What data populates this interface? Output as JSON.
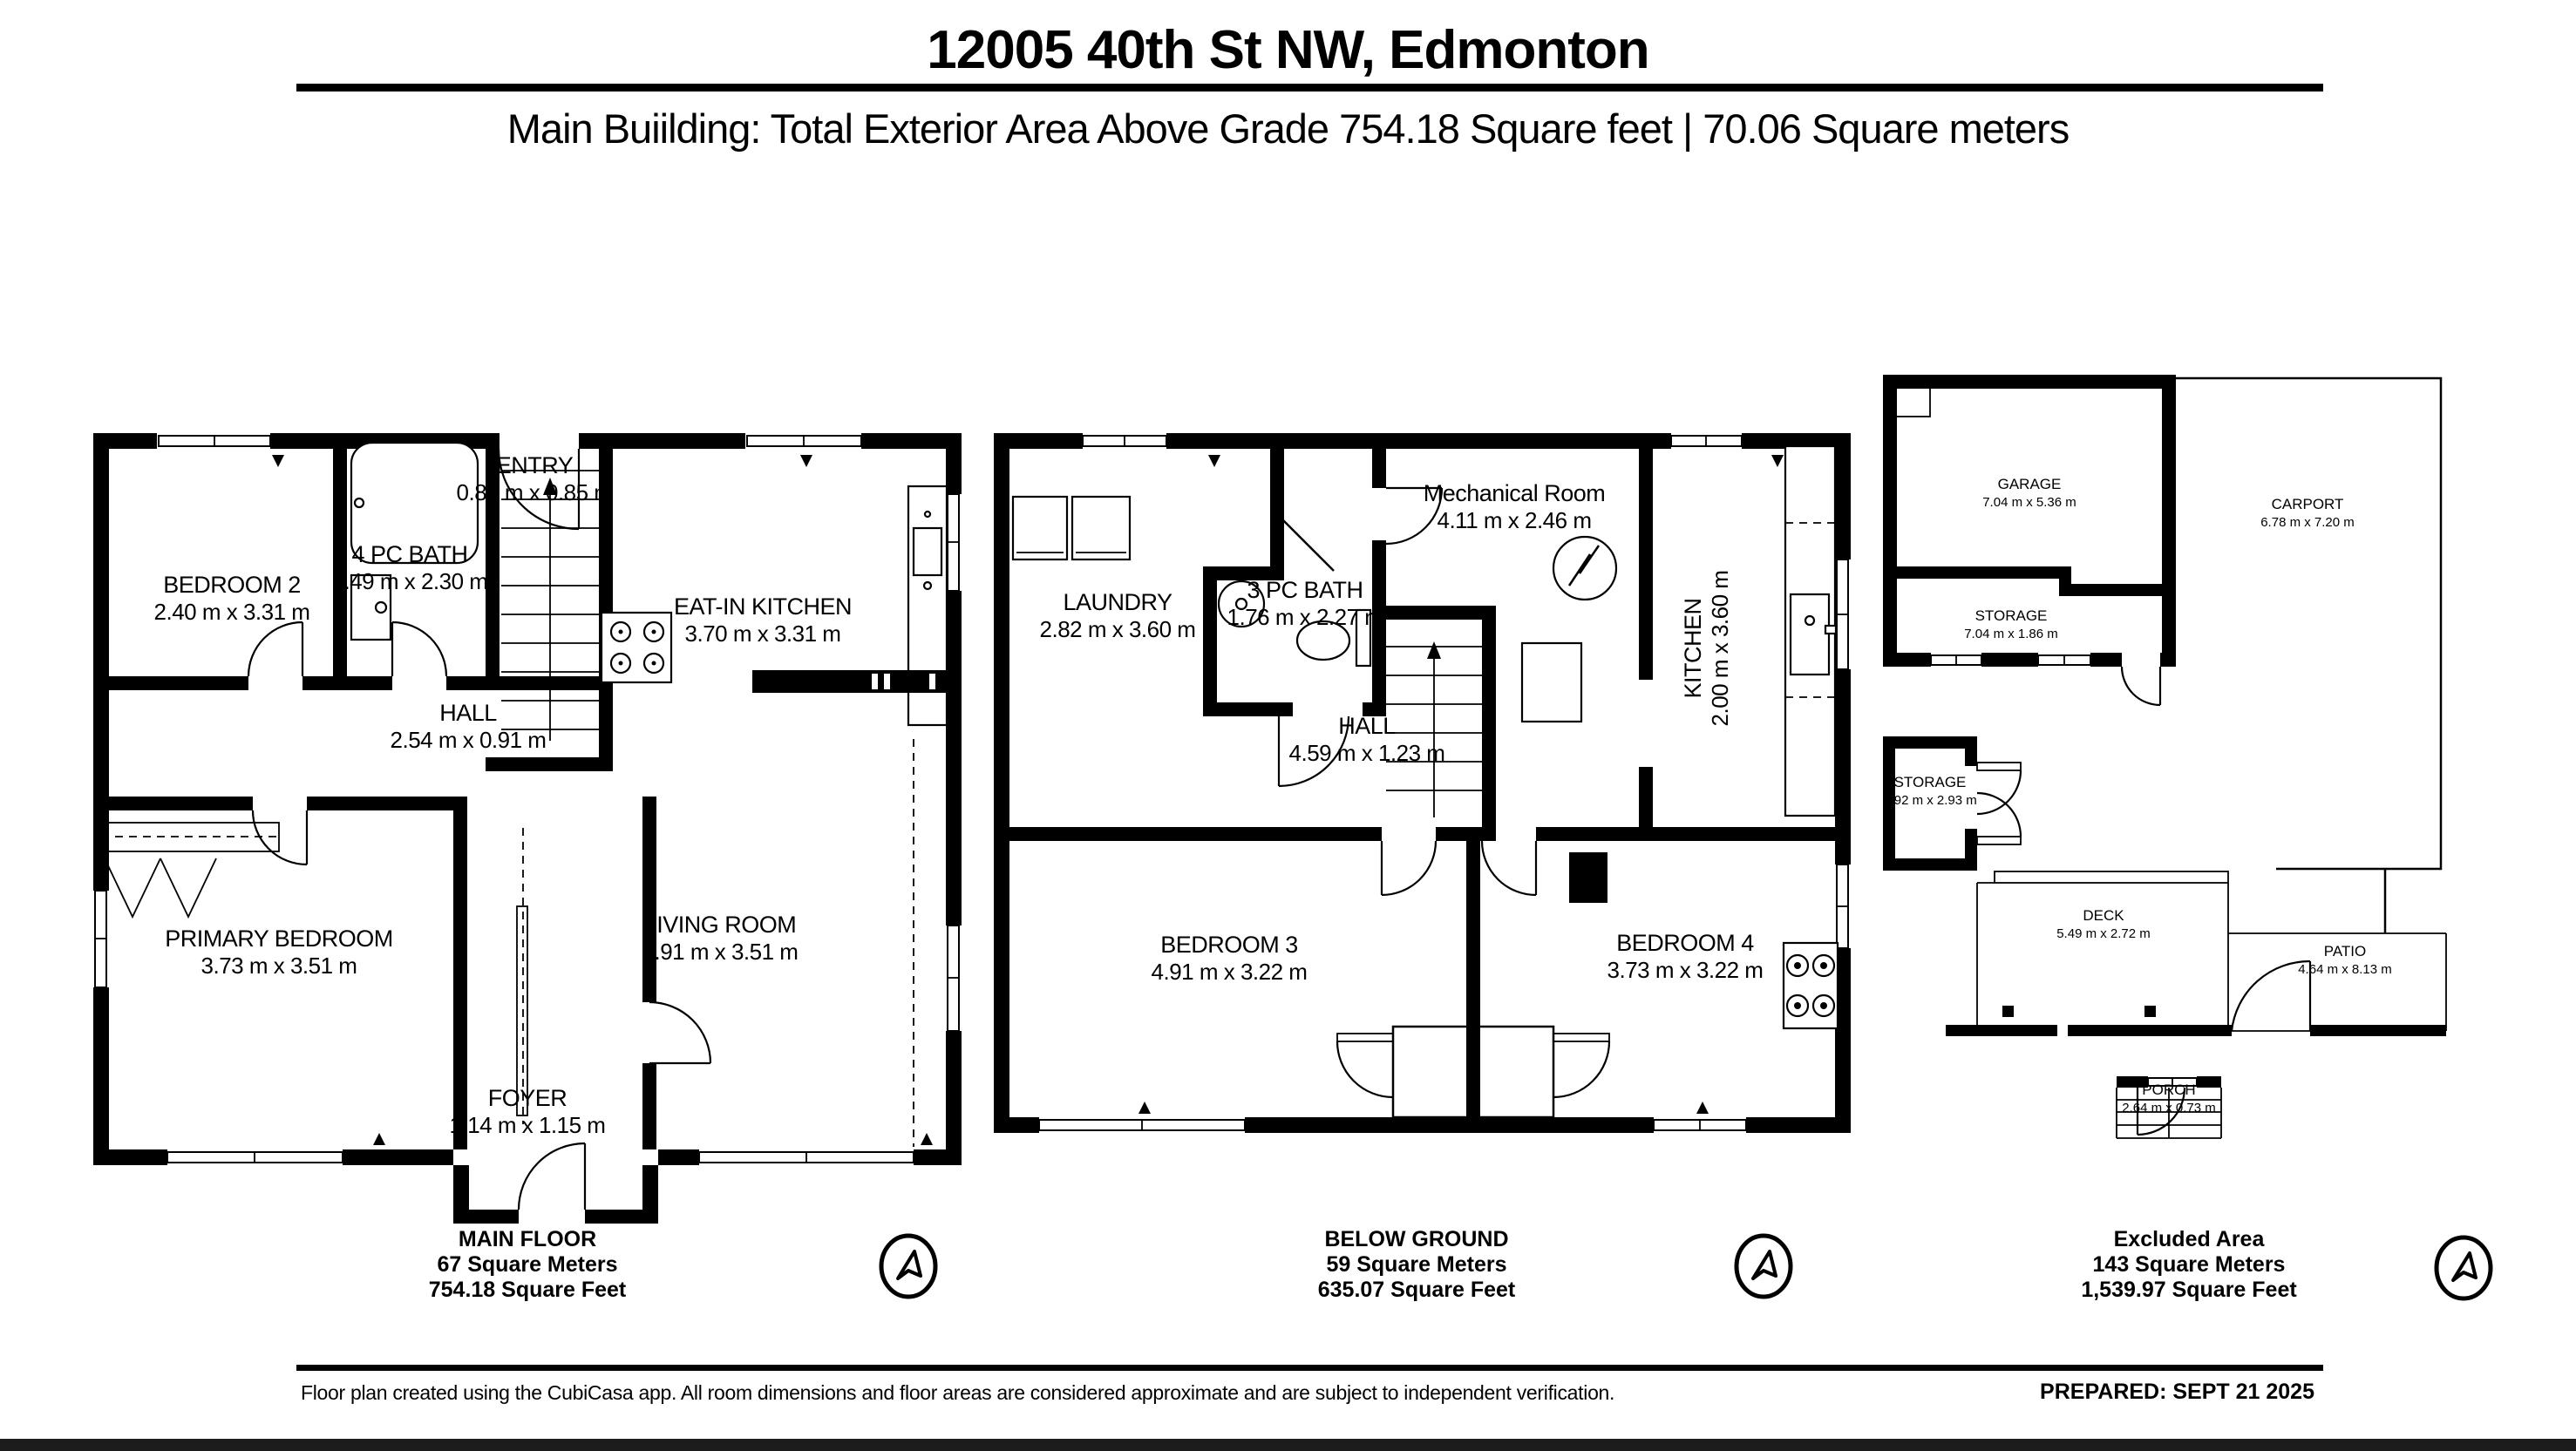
{
  "header": {
    "title": "12005 40th St NW, Edmonton",
    "subtitle": "Main Buiilding: Total Exterior Area Above Grade 754.18 Square feet | 70.06 Square meters"
  },
  "plans": [
    {
      "name": "MAIN FLOOR",
      "area_meters": "67 Square Meters",
      "area_feet": "754.18 Square Feet",
      "rooms": [
        {
          "name": "BEDROOM 2",
          "dims": "2.40 m x 3.31 m"
        },
        {
          "name": "4 PC BATH",
          "dims": "1.49 m x 2.30 m"
        },
        {
          "name": "ENTRY",
          "dims": "0.85 m x 0.85 m"
        },
        {
          "name": "EAT-IN KITCHEN",
          "dims": "3.70 m x 3.31 m"
        },
        {
          "name": "HALL",
          "dims": "2.54 m x 0.91 m"
        },
        {
          "name": "PRIMARY BEDROOM",
          "dims": "3.73 m x 3.51 m"
        },
        {
          "name": "LIVING ROOM",
          "dims": "4.91 m x 3.51 m"
        },
        {
          "name": "FOYER",
          "dims": "1.14 m x 1.15 m"
        }
      ]
    },
    {
      "name": "BELOW GROUND",
      "area_meters": "59 Square Meters",
      "area_feet": "635.07 Square Feet",
      "rooms": [
        {
          "name": "LAUNDRY",
          "dims": "2.82 m x 3.60 m"
        },
        {
          "name": "3 PC BATH",
          "dims": "1.76 m x 2.27 m"
        },
        {
          "name": "Mechanical Room",
          "dims": "4.11 m x 2.46 m"
        },
        {
          "name": "KITCHEN",
          "dims": "2.00 m x 3.60 m"
        },
        {
          "name": "HALL",
          "dims": "4.59 m x 1.23 m"
        },
        {
          "name": "BEDROOM 3",
          "dims": "4.91 m x 3.22 m"
        },
        {
          "name": "BEDROOM 4",
          "dims": "3.73 m x 3.22 m"
        }
      ]
    },
    {
      "name": "Excluded Area",
      "area_meters": "143 Square Meters",
      "area_feet": "1,539.97 Square Feet",
      "rooms": [
        {
          "name": "GARAGE",
          "dims": "7.04 m x 5.36 m"
        },
        {
          "name": "CARPORT",
          "dims": "6.78 m x 7.20 m"
        },
        {
          "name": "STORAGE",
          "dims": "7.04 m x 1.86 m"
        },
        {
          "name": "STORAGE",
          "dims": "1.92 m x 2.93 m"
        },
        {
          "name": "DECK",
          "dims": "5.49 m x 2.72 m"
        },
        {
          "name": "PATIO",
          "dims": "4.64 m x 8.13 m"
        },
        {
          "name": "PORCH",
          "dims": "2.64 m x 0.73 m"
        }
      ]
    }
  ],
  "footer": {
    "disclaimer": "Floor plan created using the CubiCasa app. All room dimensions and floor areas are considered approximate and are subject to independent verification.",
    "prepared": "PREPARED: SEPT 21 2025"
  },
  "colors": {
    "ink": "#000000",
    "paper": "#ffffff",
    "bottom_bar": "#1c1c1c"
  },
  "icons": {
    "compass": "compass-north-arrow"
  }
}
